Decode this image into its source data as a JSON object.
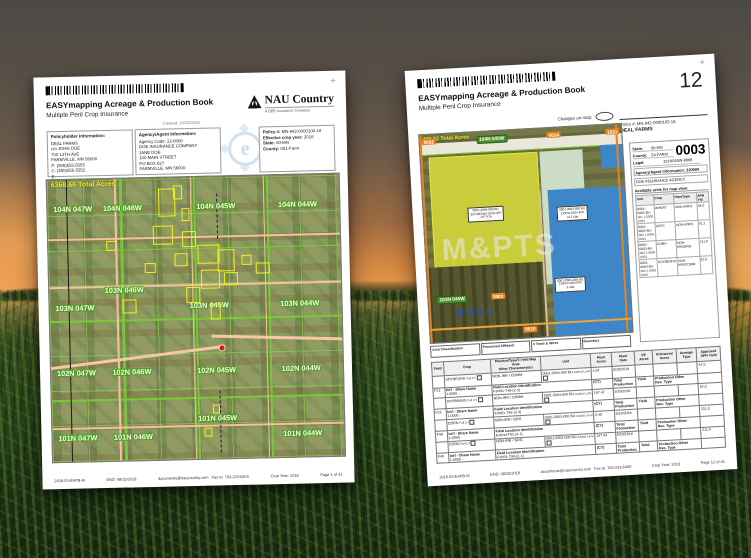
{
  "colors": {
    "field_outline_yellow": "#f3ef1f",
    "section_line_green": "#79c835",
    "road_tan": "#f2c29c",
    "water_blue": "#3d86c8",
    "crop_yellow": "#c9cd3b",
    "sage_green": "#ccdcc6",
    "pill_green": "#4a8f2a",
    "tag_orange": "#e8821e"
  },
  "left_page": {
    "title": "EASYmapping Acreage & Production Book",
    "subtitle": "Multiple Peril Crop Insurance",
    "created": "Created: 10/15/2018",
    "logo": {
      "name": "NAU Country",
      "tagline": "A QBE Insurance Company"
    },
    "policyholder": {
      "header": "Policyholder Information:",
      "lines": [
        "DEAL FARMS",
        "c/o JOHN DOE",
        "700 12TH AVE",
        "FARMVILLE, MN 56000",
        "P:  (555)555-5555",
        "C:  (555)555-5552",
        "E:"
      ]
    },
    "agency": {
      "header": "Agency/Agent Information:",
      "lines": [
        "Agency Code: 22-0000",
        "DOE INSURANCE COMPANY",
        "JANE DOE",
        "100 MAIN STREET",
        "PO BOX 627",
        "FARMVILLE, MN 56000"
      ]
    },
    "policy": {
      "rows": [
        {
          "label": "Policy #:",
          "value": "MN-942-0000100-18"
        },
        {
          "label": "Effective crop year:",
          "value": "2018"
        },
        {
          "label": "State:",
          "value": "00-MN"
        },
        {
          "label": "County:",
          "value": "001-Farm"
        }
      ]
    },
    "map": {
      "total_acres": "6368.66 Total Acres",
      "townships": [
        "104N 047W",
        "104N 046W",
        "104N 045W",
        "104N 044W",
        "103N 047W",
        "103N 046W",
        "103N 045W",
        "103N 044W",
        "102N 047W",
        "102N 046W",
        "102N 045W",
        "102N 044W",
        "101N 047W",
        "101N 046W",
        "101N 045W",
        "101N 044W"
      ]
    },
    "footer": {
      "form": "2018.03-EAPB-M",
      "end": "END: 08/15/2018",
      "email": "documents@naucountry.com",
      "fax": "Fax to: 763-233-6400",
      "crop_year": "Crop Year: 2018",
      "page": "Page 1 of 41"
    }
  },
  "right_page": {
    "title": "EASYmapping Acreage & Production Book",
    "subtitle": "Multiple Peril Crop Insurance",
    "page_number": "12",
    "changes_label": "Changes on map:",
    "policy_line": "Policy #:  MN-942-0000100-18",
    "insured": "DEAL FARMS",
    "map": {
      "total_acres": "409.32 Total Acres",
      "township_top": "104N 045W",
      "township_bottom": "103N 045W",
      "place": "ROCK",
      "watermark": "M&PTS",
      "road_tags": [
        "0022",
        "0014",
        "1031",
        "0010",
        "0003"
      ],
      "labels": [
        "0001-0004-000 BU\nSOYBEANS NON-IRR\n197.47a",
        "0001-0003-000 BU\nCORN NON-IRR\n147.44a",
        "0001-0003-000 BU\nCORN NON-IRR\n3.40a"
      ]
    },
    "sidebar": {
      "farm_number": "0003",
      "info": [
        {
          "label": "State:",
          "value": "00-MN"
        },
        {
          "label": "County:",
          "value": "54-FARM"
        },
        {
          "label": "Legal:",
          "value": "101N045W-8888"
        }
      ],
      "agency_line": "Agency/Agent Information: 220000",
      "agency_name": "DOE INSURANCE AGENCY",
      "units_header": "Available units for map view:",
      "units_columns": [
        "Unit",
        "Crop",
        "Plan/Type",
        "APH Yld"
      ],
      "units": [
        {
          "unit": "0001-0001-BU",
          "crop": "WHEAT",
          "plan": "NON-IRR/S",
          "aph": "46.0",
          "sub": "001   1.0000   A001"
        },
        {
          "unit": "0001-0002-BU",
          "crop": "OATS",
          "plan": "NON-IRR/S",
          "aph": "91.2",
          "sub": "002   1.0000   A001"
        },
        {
          "unit": "0001-0003-BU",
          "crop": "CORN",
          "plan": "NON-IRR/GRG",
          "aph": "211.0",
          "sub": "003   1.0000   A001"
        },
        {
          "unit": "0001-0004-BU",
          "crop": "SOYBEANS",
          "plan": "NON-IRR/COMM",
          "aph": "57.0",
          "sub": "004   1.0000   A001"
        }
      ]
    },
    "strip": [
      "Area Classification",
      "Processed Affidavit",
      "# Trees & Wires",
      "Boundary"
    ],
    "table": {
      "headers": [
        "Field",
        "Crop",
        "Practice/Type/T-Yield Map Area\nOther Characteristics",
        "Unit",
        "Plant\nAcres",
        "Plant\nDate",
        "PP\nAcres",
        "Uninsured\nAcres",
        "Acreage\nType",
        "Approved\nAPH Yield"
      ],
      "sub_labels": {
        "share_name": "Int'l - Share Name",
        "share_value": "1.0000  -",
        "fli": "Field Location Identification",
        "cy": "(CY)",
        "total_production": "Total Production",
        "yield_lbl": "Yield",
        "prod_other": "Production Other\nRec. Type",
        "fall_cy": "Fall CY",
        "added_land": "Added Land"
      },
      "rows": [
        {
          "field": "F21",
          "crop": "SOYBEANS",
          "practice": "NON-IRR / COMM",
          "unit": "0001-0004-000 BU",
          "plant_acres": "4.97",
          "plant_date": "5/29/2018",
          "aph": "57.0",
          "location": "FsN91-T48-(2-3)"
        },
        {
          "field": "F22",
          "crop": "SOYBEANS",
          "practice": "NON-IRR / COMM",
          "unit": "0001-0004-000 BU",
          "plant_acres": "197.47",
          "plant_date": "5/29/2018",
          "aph": "57.0",
          "location": "FsN91-T48-(2-3)"
        },
        {
          "field": "F48",
          "crop": "CORN",
          "practice": "NON-IRR / GRG",
          "unit": "0001-0003-000 BU",
          "plant_acres": "3.40",
          "plant_date": "5/19/2018",
          "aph": "211.0",
          "location": "FsGrid-T91-(4-1)"
        },
        {
          "field": "F49",
          "crop": "CORN",
          "practice": "NON-IRR / GRG",
          "unit": "0001-0003-000 BU",
          "plant_acres": "147.44",
          "plant_date": "5/19/2018",
          "aph": "211.0",
          "location": "FsN91-T99-(2-1)"
        }
      ]
    },
    "footer": {
      "form": "2018.03-EAPB-M",
      "end": "END: 08/15/2018",
      "email": "documents@naucountry.com",
      "fax": "Fax to: 763-233-6400",
      "crop_year": "Crop Year: 2018",
      "page": "Page 12 of 41"
    }
  }
}
